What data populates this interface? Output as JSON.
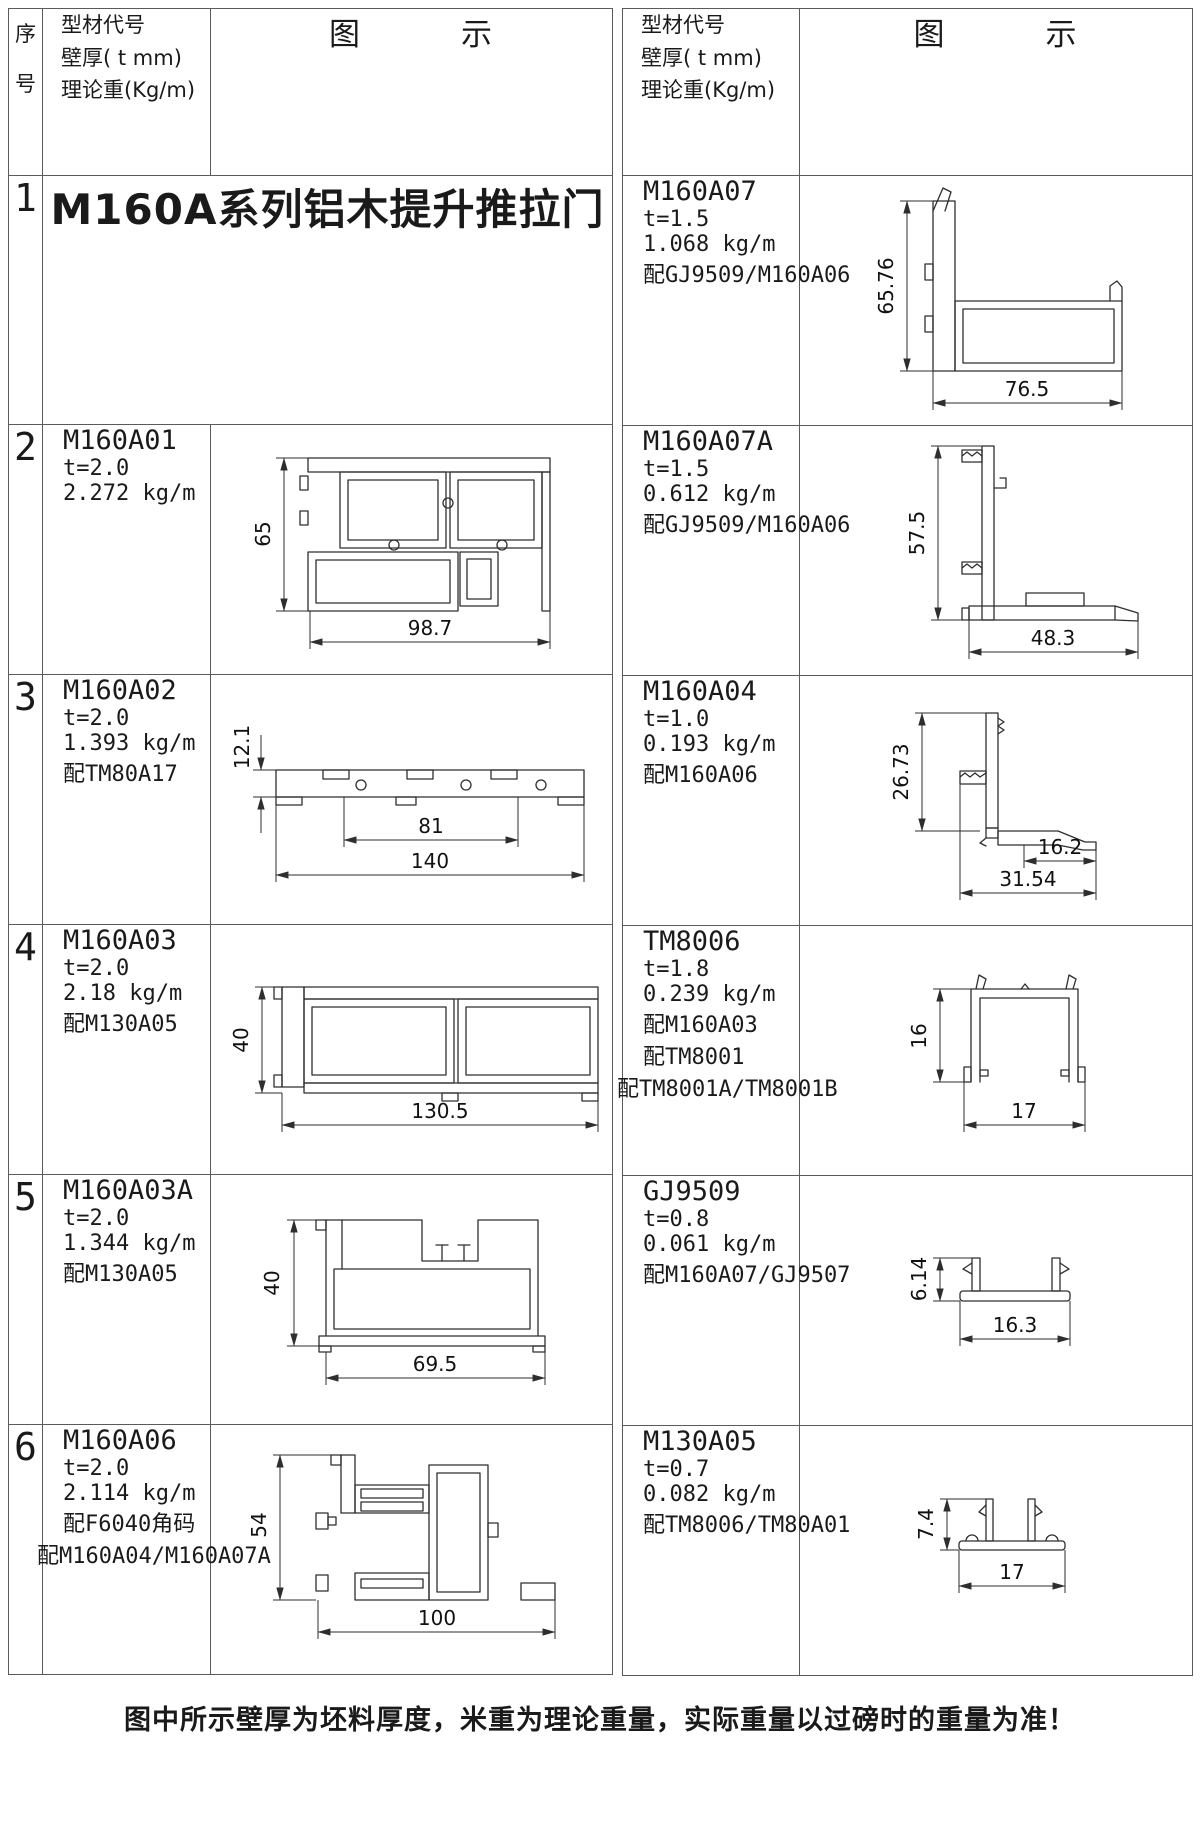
{
  "header": {
    "seq_label": "序号",
    "spec_lines": [
      "型材代号",
      "壁厚( t mm)",
      "理论重(Kg/m)"
    ],
    "diagram_label": "图　　　示"
  },
  "left_rows": [
    {
      "seq": "1",
      "title": "M160A系列铝木提升推拉门"
    },
    {
      "seq": "2",
      "code": "M160A01",
      "thickness": "t=2.0",
      "weight": "2.272 kg/m",
      "dims": {
        "v": "65",
        "h": "98.7"
      }
    },
    {
      "seq": "3",
      "code": "M160A02",
      "thickness": "t=2.0",
      "weight": "1.393 kg/m",
      "match1": "配TM80A17",
      "dims": {
        "v": "12.1",
        "h1": "81",
        "h2": "140"
      }
    },
    {
      "seq": "4",
      "code": "M160A03",
      "thickness": "t=2.0",
      "weight": "2.18 kg/m",
      "match1": "配M130A05",
      "dims": {
        "v": "40",
        "h": "130.5"
      }
    },
    {
      "seq": "5",
      "code": "M160A03A",
      "thickness": "t=2.0",
      "weight": "1.344 kg/m",
      "match1": "配M130A05",
      "dims": {
        "v": "40",
        "h": "69.5"
      }
    },
    {
      "seq": "6",
      "code": "M160A06",
      "thickness": "t=2.0",
      "weight": "2.114 kg/m",
      "match1": "配F6040角码",
      "match2": "配M160A04/M160A07A",
      "dims": {
        "v": "54",
        "h": "100"
      }
    }
  ],
  "right_rows": [
    {
      "code": "M160A07",
      "thickness": "t=1.5",
      "weight": "1.068 kg/m",
      "match1": "配GJ9509/M160A06",
      "dims": {
        "v": "65.76",
        "h": "76.5"
      }
    },
    {
      "code": "M160A07A",
      "thickness": "t=1.5",
      "weight": "0.612 kg/m",
      "match1": "配GJ9509/M160A06",
      "dims": {
        "v": "57.5",
        "h": "48.3"
      }
    },
    {
      "code": "M160A04",
      "thickness": "t=1.0",
      "weight": "0.193 kg/m",
      "match1": "配M160A06",
      "dims": {
        "v": "26.73",
        "h1": "16.2",
        "h2": "31.54"
      }
    },
    {
      "code": "TM8006",
      "thickness": "t=1.8",
      "weight": "0.239 kg/m",
      "match1": "配M160A03",
      "match2": "配TM8001",
      "match3": "配TM8001A/TM8001B",
      "dims": {
        "v": "16",
        "h": "17"
      }
    },
    {
      "code": "GJ9509",
      "thickness": "t=0.8",
      "weight": "0.061 kg/m",
      "match1": "配M160A07/GJ9507",
      "dims": {
        "v": "6.14",
        "h": "16.3"
      }
    },
    {
      "code": "M130A05",
      "thickness": "t=0.7",
      "weight": "0.082 kg/m",
      "match1": "配TM8006/TM80A01",
      "dims": {
        "v": "7.4",
        "h": "17"
      }
    }
  ],
  "footer": {
    "note": "图中所示壁厚为坯料厚度，米重为理论重量，实际重量以过磅时的重量为准！"
  }
}
